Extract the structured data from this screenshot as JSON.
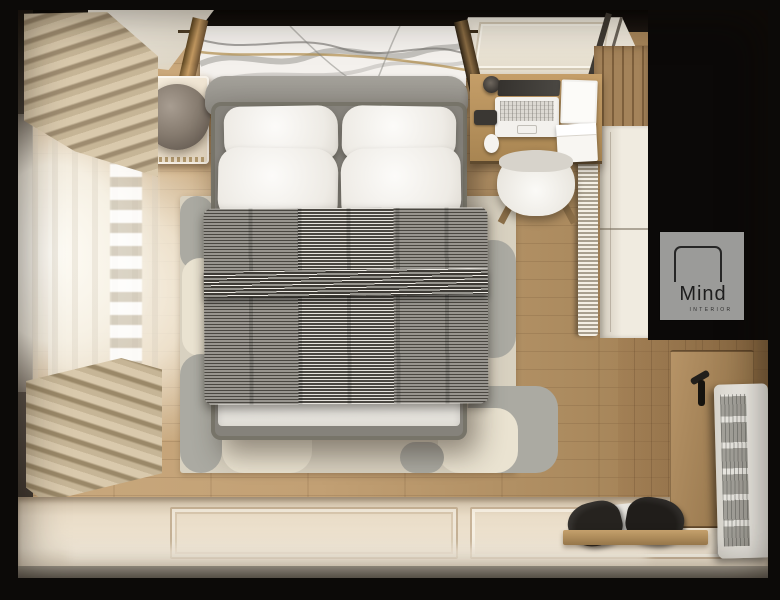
{
  "image": {
    "type": "3d-interior-render",
    "view": "top-down bird's-eye view",
    "subject": "modern bedroom interior visualization on black background"
  },
  "logo": {
    "title": "Mind",
    "subtitle": "INTERIOR"
  },
  "palette": {
    "background": "#0c0a08",
    "floor_wood": "#bb9768",
    "rug_cream": "#d8d1c0",
    "rug_gray": "#abaaa2",
    "duvet_dark_stripe": "#4a4741",
    "duvet_light_stripe": "#e6e3dd",
    "bed_frame_gray": "#85827b",
    "pillow_white": "#f5f3ef",
    "curtain_beige": "#cbba9c",
    "wall_cream": "#f2e8d6",
    "desk_wood": "#b8935f",
    "wardrobe_white": "#ece6da",
    "door_wood": "#a98a5d",
    "radiator_white": "#eceae4",
    "logo_bg": "#9b9b99",
    "logo_text": "#1d1d1d"
  },
  "scene_objects": [
    "double bed with gray striped duvet, white foot sheet and four white pillows",
    "marble art panel above gray upholstered headboard",
    "nightstand with spherical taupe lamp and warm glow",
    "beige pleated curtains and sheer white curtain along left window wall",
    "wooden desk with open laptop, cup, phone, mouse and paper stacks",
    "white desk chair",
    "wood slat wall section and white wardrobe on right wall",
    "knitted throw hanging beside wardrobe",
    "abstract cream and gray area rug",
    "paneled cream bottom wall with baseboard",
    "wooden entry door with black handle (bottom right)",
    "white wall radiator with grille (bottom right)",
    "wooden bench with black duffel bag",
    "Mind Interior logo watermark"
  ]
}
